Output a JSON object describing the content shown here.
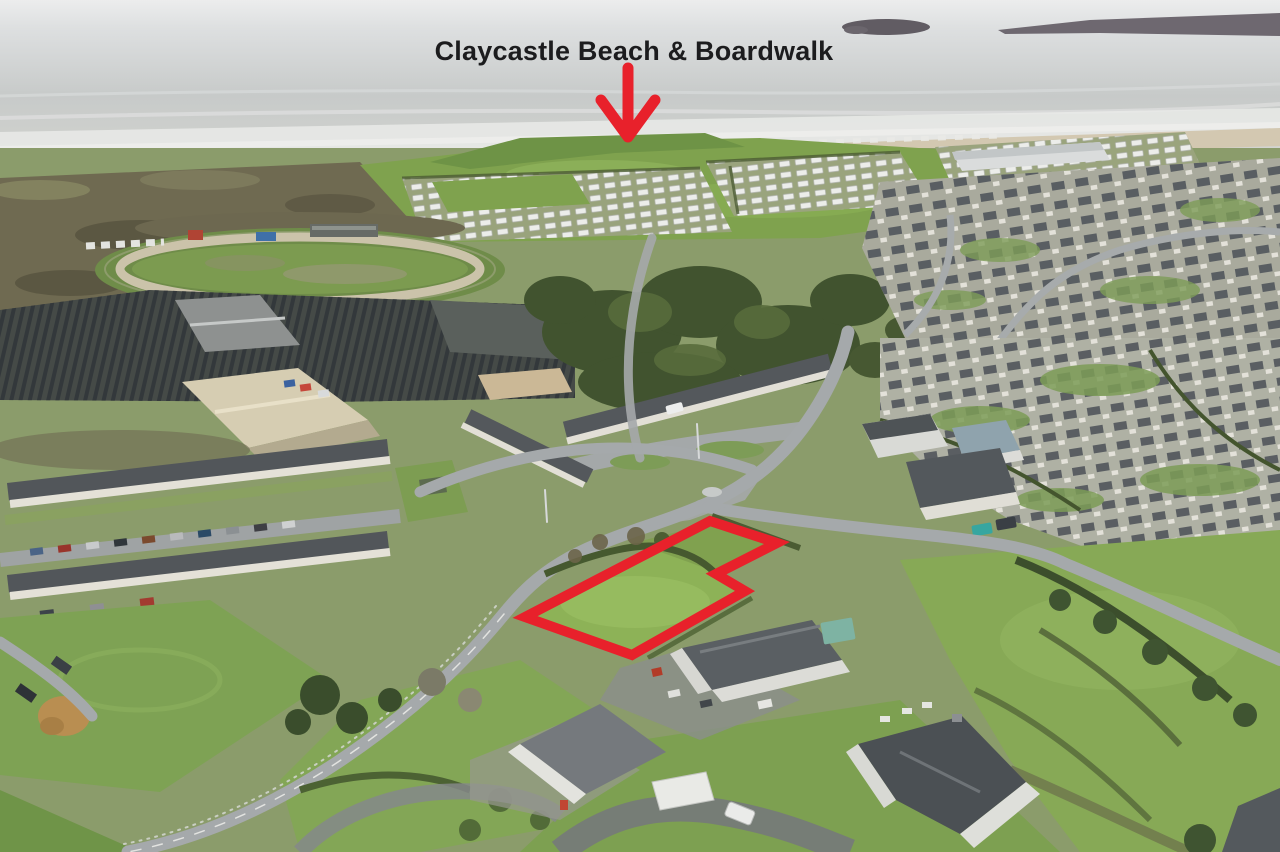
{
  "annotation": {
    "label": "Claycastle Beach & Boardwalk",
    "arrow_path": "M 628 68 L 628 134 M 601 100 L 628 137 M 655 100 L 628 137"
  },
  "site_outline": {
    "points": "710,521 777,543 716,574 745,591 632,655 525,617"
  },
  "colors": {
    "annotation-red": "#e8212b",
    "label-color": "#1c1c1e"
  }
}
